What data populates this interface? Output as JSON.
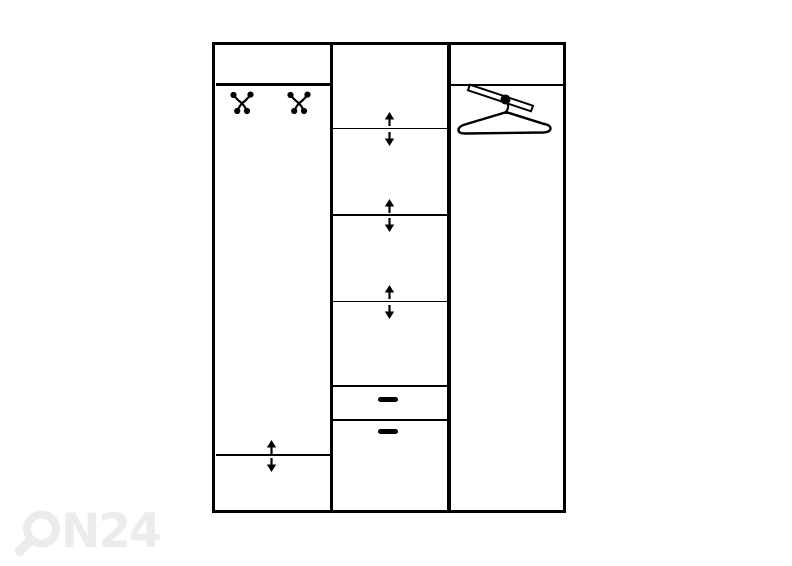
{
  "canvas": {
    "width": 792,
    "height": 566,
    "background": "#ffffff",
    "line_color": "#000000"
  },
  "watermark": {
    "text": "N24",
    "brand": "ON24",
    "color": "#ececec"
  },
  "diagram": {
    "type": "wardrobe-front-schematic",
    "columns": [
      {
        "id": "left",
        "elements": [
          "top-shelf",
          "coat-hook",
          "coat-hook",
          "height-adjustable-shelf"
        ]
      },
      {
        "id": "middle",
        "elements": [
          "height-adjustable-shelf",
          "height-adjustable-shelf",
          "height-adjustable-shelf",
          "drawer",
          "drawer"
        ]
      },
      {
        "id": "right",
        "elements": [
          "top-shelf",
          "hanger-rail"
        ]
      }
    ]
  },
  "icons": {
    "coat_hook": "double-hook-with-ball-ends",
    "hanger": "clothes-hanger-on-diagonal-rail",
    "adjust_up": "filled-up-arrow",
    "adjust_down": "filled-down-arrow",
    "drawer_handle": "rounded-bar"
  }
}
